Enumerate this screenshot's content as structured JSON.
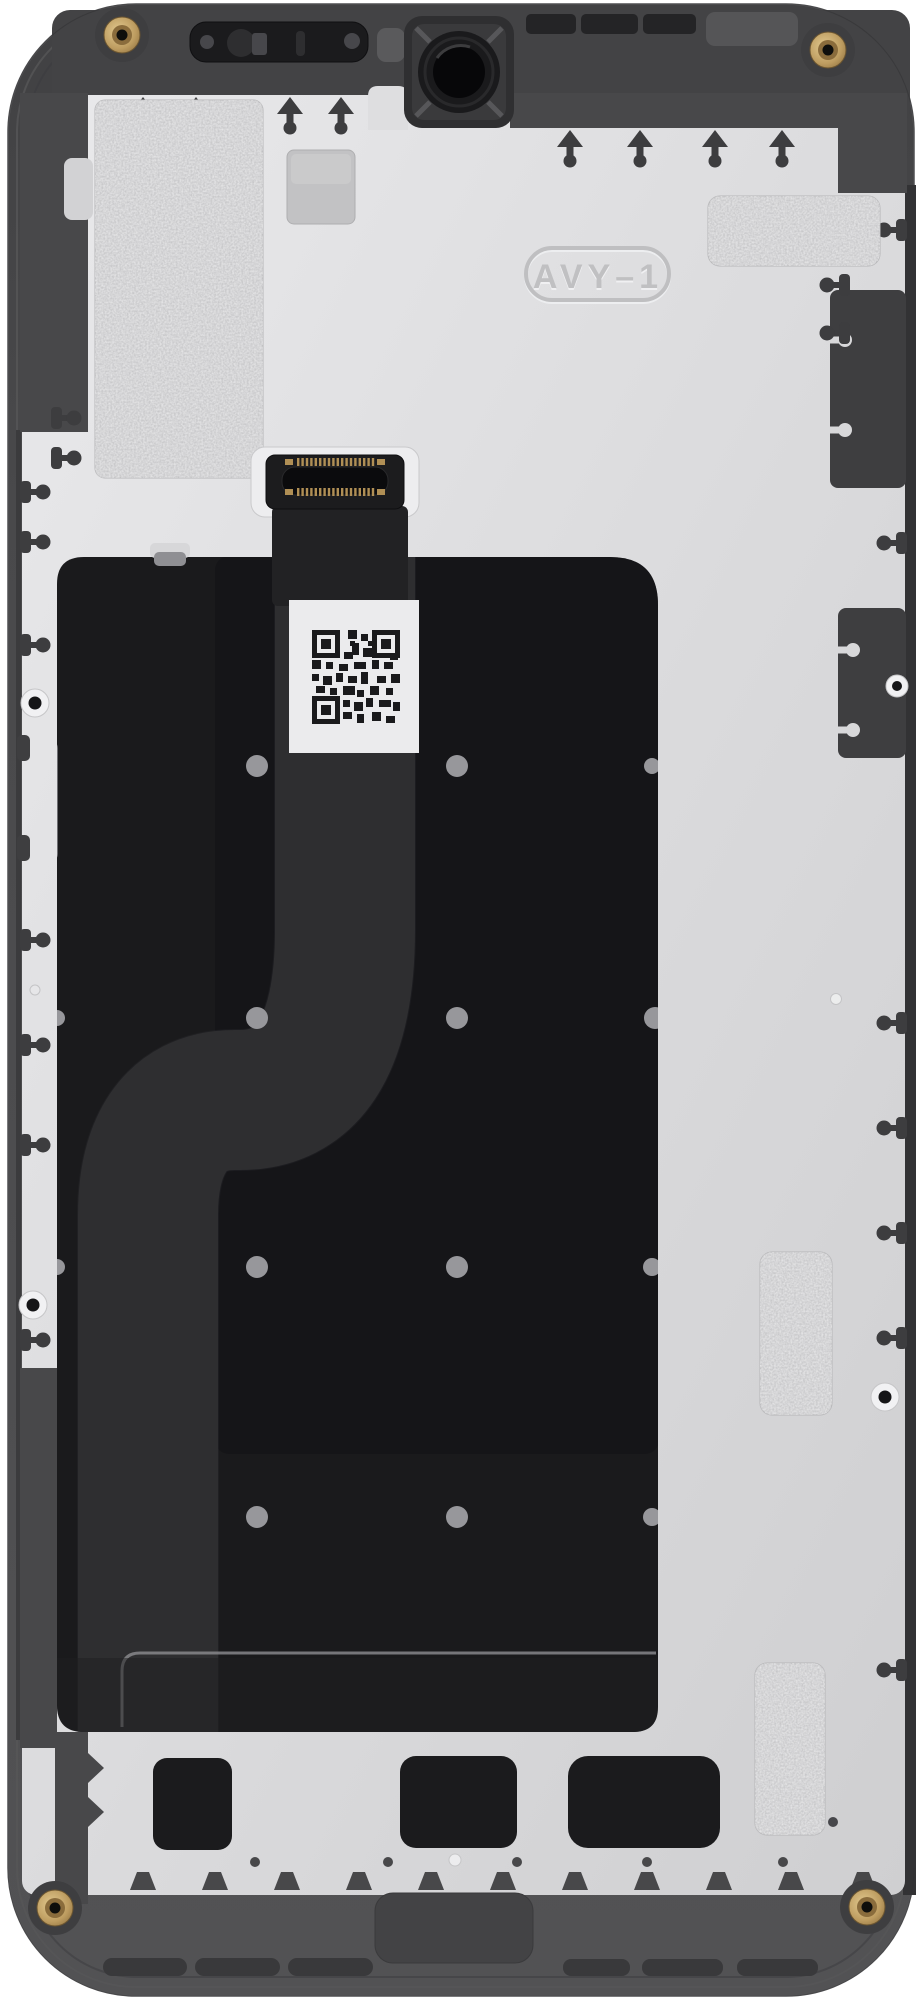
{
  "scene": {
    "description": "Rear view photograph of a smartphone display assembly / midframe spare part",
    "part_marking": "AVY–1",
    "labels": {
      "qr_label": "QR code serial label (content not readable)"
    },
    "colors": {
      "background": "#ffffff",
      "frame": "#4a4a4c",
      "frame_dark": "#3d3d3f",
      "frame_top": "#434345",
      "back_panel": "#dcdcde",
      "panel_highlight": "#e9e9eb",
      "panel_shadow": "#d0d0d2",
      "graphite_sheet": "#19191b",
      "display_back": "#141416",
      "flex_cable": "#2b2b2d",
      "foil_sticker": "#c6c6c8",
      "brass_screw": "#c2a263",
      "qr_label_bg": "#ebebed",
      "screw_dots": "#97979b",
      "marking_text": "#c3c3c5"
    },
    "components": {
      "earpiece_speaker": "earpiece speaker slot",
      "front_camera": "front camera opening",
      "corner_screws": 4,
      "edge_screw_bosses": 4,
      "foil_stickers": 5,
      "board_connector": "display flex board-to-board connector",
      "flex_cable": "S-routed display flex ribbon",
      "bottom_cutouts": 3,
      "bottom_grille_slots": 6
    }
  }
}
